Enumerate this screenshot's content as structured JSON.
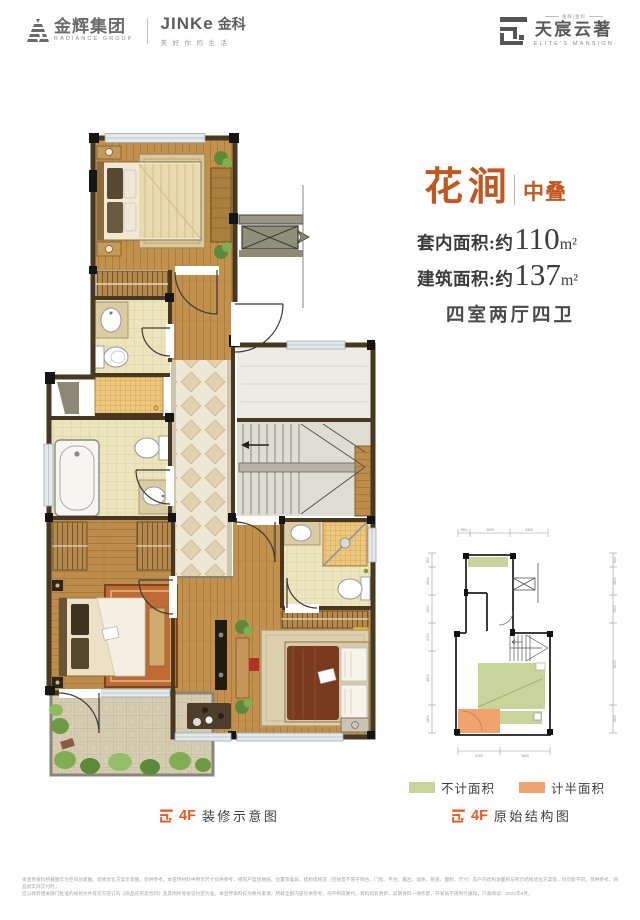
{
  "header": {
    "radiance_cn": "金辉集团",
    "radiance_en": "RADIANCE GROUP",
    "jinke_brand": "JINKe",
    "jinke_cn": "金科",
    "jinke_tagline": "美好你的生活",
    "mansion_small": "金辉|金科",
    "mansion_cn": "天宸云著",
    "mansion_en": "ELITE'S MANSION"
  },
  "unit": {
    "name": "花涧",
    "tier": "中叠",
    "inner_area_label": "套内面积:约",
    "inner_area_value": "110",
    "inner_area_unit": "m²",
    "gross_area_label": "建筑面积:约",
    "gross_area_value": "137",
    "gross_area_unit": "m²",
    "rooms": "四室两厅四卫"
  },
  "captions": {
    "floor": "4F",
    "left_text": "装修示意图",
    "right_text": "原始结构图"
  },
  "legend": {
    "green_label": "不计面积",
    "orange_label": "计半面积",
    "green_color": "#c7d59b",
    "orange_color": "#f1a36e"
  },
  "structure": {
    "dims_top": [
      "850",
      "3600",
      "3300"
    ],
    "dims_bottom": [
      "3150",
      "3600"
    ],
    "dims_left": [
      "900",
      "2600",
      "1500",
      "2000",
      "3600",
      "1500"
    ],
    "dims_right": [
      "900",
      "2600",
      "1500",
      "6000",
      "1500"
    ]
  },
  "colors": {
    "accent_orange": "#c4571e",
    "floor_tag_orange": "#f0571e"
  },
  "disclaimer": {
    "line1": "本宣传资料所载图示为空间创意图、装修优化方案示意图，仅供参考。本宣传材料中所示尺寸仅供参考，相同户型因楼层、位置等差异，结构或构造（包括但不限于阳台、门窗、平台、露台、墙体、管道、面积、尺寸）及户内结构净面积与所示结构优化方案等，均可能不同，仅供参考。商品房实际交付时，",
    "line2": "应以政府相关部门批准的规划文件及双方签订的《商品房买卖合同》及其附件等协议约定为准。本宣传资料仅为要约邀请，所载全部内容仅供参考，均不构成要约。资料如有更新，前期资料一律作废，开发商不再另行通知，只限阅读：2020年6月。"
  }
}
